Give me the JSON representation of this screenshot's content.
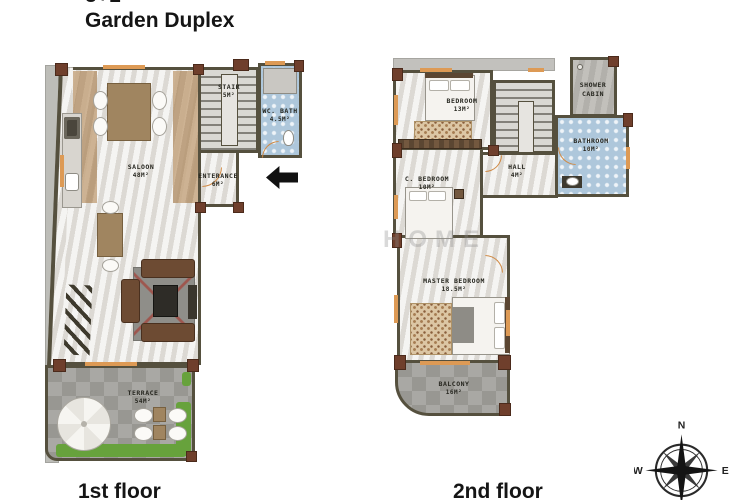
{
  "title": {
    "line1": "3+1",
    "line2": "Garden Duplex"
  },
  "floor1": {
    "caption": "1st floor",
    "rooms": {
      "saloon": {
        "name": "SALOON",
        "area": "48M²"
      },
      "stair": {
        "name": "STAIR",
        "area": "5M²"
      },
      "wc_bath": {
        "name": "WC. BATH",
        "area": "4.5M²"
      },
      "enterance": {
        "name": "ENTERANCE",
        "area": "6M²"
      },
      "terrace": {
        "name": "TERRACE",
        "area": "54M²"
      }
    }
  },
  "floor2": {
    "caption": "2nd floor",
    "rooms": {
      "bedroom": {
        "name": "BEDROOM",
        "area": "13M²"
      },
      "shower_cabin": {
        "name": "SHOWER CABIN",
        "area": ""
      },
      "bathroom": {
        "name": "BATHROOM",
        "area": "10M²"
      },
      "hall": {
        "name": "HALL",
        "area": "4M²"
      },
      "c_bedroom": {
        "name": "C. BEDROOM",
        "area": "10M²"
      },
      "master_bedroom": {
        "name": "MASTER BEDROOM",
        "area": "18.5M²"
      },
      "balcony": {
        "name": "BALCONY",
        "area": "16M²"
      }
    }
  },
  "compass": {
    "north": "N",
    "east": "E",
    "south": "S",
    "west": "W"
  },
  "watermark": "HOME",
  "colors": {
    "wall": "#55503e",
    "accent_orange": "#dd9a55",
    "tile_blue": "#aec7db",
    "grass_green": "#67a23c",
    "pillar_brown": "#6f3f2c"
  }
}
